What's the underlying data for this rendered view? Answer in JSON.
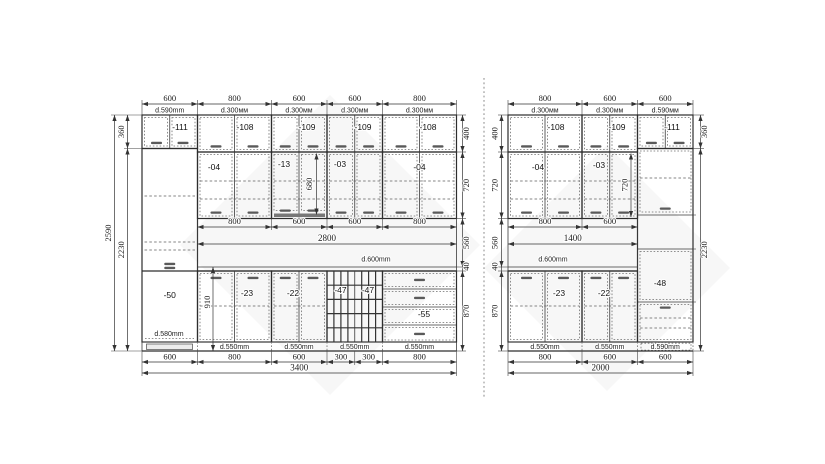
{
  "left": {
    "top_dims": [
      "600",
      "800",
      "600",
      "600",
      "800"
    ],
    "top_depths": [
      "d.590mm",
      "d.300мм",
      "d.300мм",
      "d.300мм",
      "d.300мм"
    ],
    "upper_codes": [
      "-111",
      "-108",
      "-109",
      "-109",
      "-108"
    ],
    "tall_codes": [
      "-04",
      "-13",
      "-03",
      "-04"
    ],
    "inner_height": "680",
    "mid_dims": [
      "800",
      "600",
      "600",
      "800"
    ],
    "counter_width": "2800",
    "counter_depth": "d.600mm",
    "base_codes": [
      "-50",
      "-23",
      "-22",
      "-47",
      "-47",
      "-55"
    ],
    "base_height": "910",
    "tall_depth": "d.580mm",
    "bottom_depths": [
      "d.550mm",
      "d.550mm",
      "d.550mm",
      "d.550mm"
    ],
    "bottom_dims": [
      "600",
      "800",
      "600",
      "300",
      "300",
      "800"
    ],
    "total_width": "3400",
    "left_heights": [
      "360",
      "2230"
    ],
    "overall_height": "2590",
    "right_heights": [
      "400",
      "720",
      "560",
      "40",
      "870"
    ]
  },
  "right": {
    "top_dims": [
      "800",
      "600",
      "600"
    ],
    "top_depths": [
      "d.300мм",
      "d.300мм",
      "d.590мм"
    ],
    "upper_codes": [
      "-108",
      "-109",
      "-111"
    ],
    "tall_codes": [
      "-04",
      "-03"
    ],
    "inner_height": "720",
    "mid_dims": [
      "800",
      "600"
    ],
    "counter_width": "1400",
    "counter_depth": "d.600mm",
    "base_codes": [
      "-23",
      "-22"
    ],
    "tall_code": "-48",
    "bottom_depths": [
      "d.550mm",
      "d.550mm",
      "d.590mm"
    ],
    "bottom_dims": [
      "800",
      "600",
      "600"
    ],
    "total_width": "2000",
    "left_heights": [
      "400",
      "720",
      "560",
      "40",
      "870"
    ],
    "right_heights": [
      "360",
      "2230"
    ]
  }
}
